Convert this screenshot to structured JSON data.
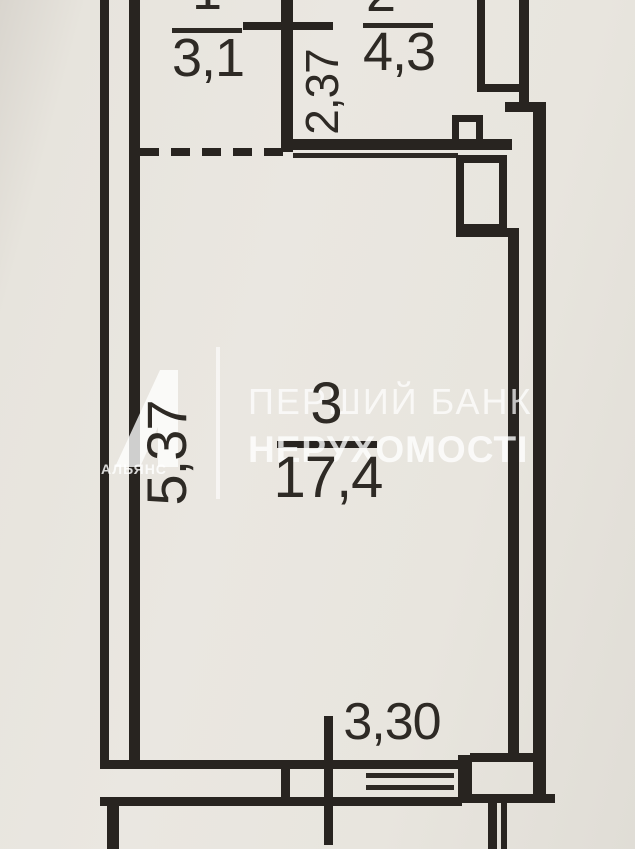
{
  "plan": {
    "type": "apartment-floor-plan",
    "rooms": [
      {
        "number": "1",
        "area": "3,1"
      },
      {
        "number": "2",
        "area": "4,3"
      },
      {
        "number": "3",
        "area": "17,4"
      }
    ],
    "dimensions": [
      {
        "id": "corridor-width",
        "value": "2,37",
        "orientation": "vertical"
      },
      {
        "id": "room-depth",
        "value": "5,37",
        "orientation": "vertical"
      },
      {
        "id": "room-width",
        "value": "3,30",
        "orientation": "horizontal"
      }
    ]
  },
  "watermark": {
    "line1": "ПЕРШИЙ БАНК",
    "line2": "НЕРУХОМОСТІ",
    "logo_text": "АЛЬЯНС",
    "logo_icon": "alliance-a-logo",
    "color": "#ffffff"
  },
  "colors": {
    "background": "#e8e5de",
    "wall": "#282420",
    "label_text": "#2e2a25"
  }
}
